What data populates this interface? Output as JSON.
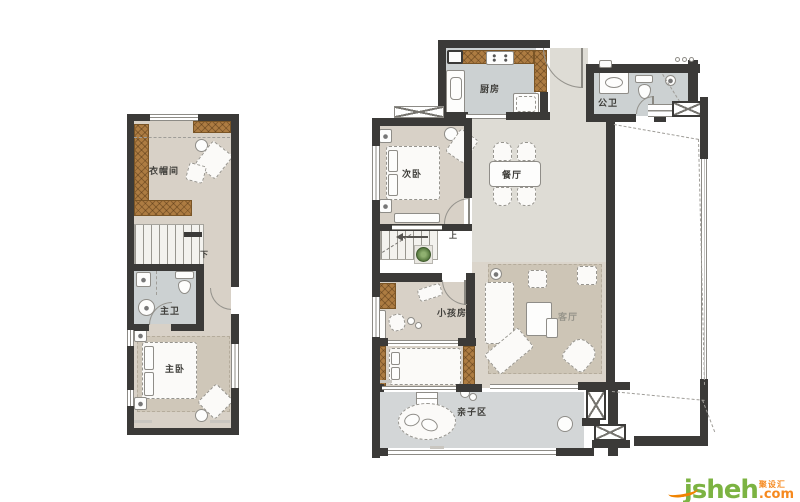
{
  "plans": {
    "upper": {
      "rooms": {
        "cloakroom": "衣帽间",
        "master_bath": "主卫",
        "master_bedroom": "主卧"
      },
      "stair_label": "下"
    },
    "main": {
      "rooms": {
        "kitchen": "厨房",
        "public_bath": "公卫",
        "second_bedroom": "次卧",
        "dining_room": "餐厅",
        "kids_room": "小孩房",
        "living_room": "客厅",
        "family_area": "亲子区"
      },
      "stair_label": "上"
    }
  },
  "watermark": {
    "brand": "jsheh",
    "suffix": ".com",
    "cn_name": "聚设汇"
  },
  "colors": {
    "wall": "#3b3a38",
    "wood": "#ad7c42",
    "floor_beige": "#d8d1c7",
    "floor_gray": "#ccd1d2",
    "floor_hall": "#dedcd5",
    "floor_family": "#d3d6d7",
    "rug": "#cdc5b6",
    "brand_green": "#7cb342",
    "brand_orange": "#f6891e"
  }
}
